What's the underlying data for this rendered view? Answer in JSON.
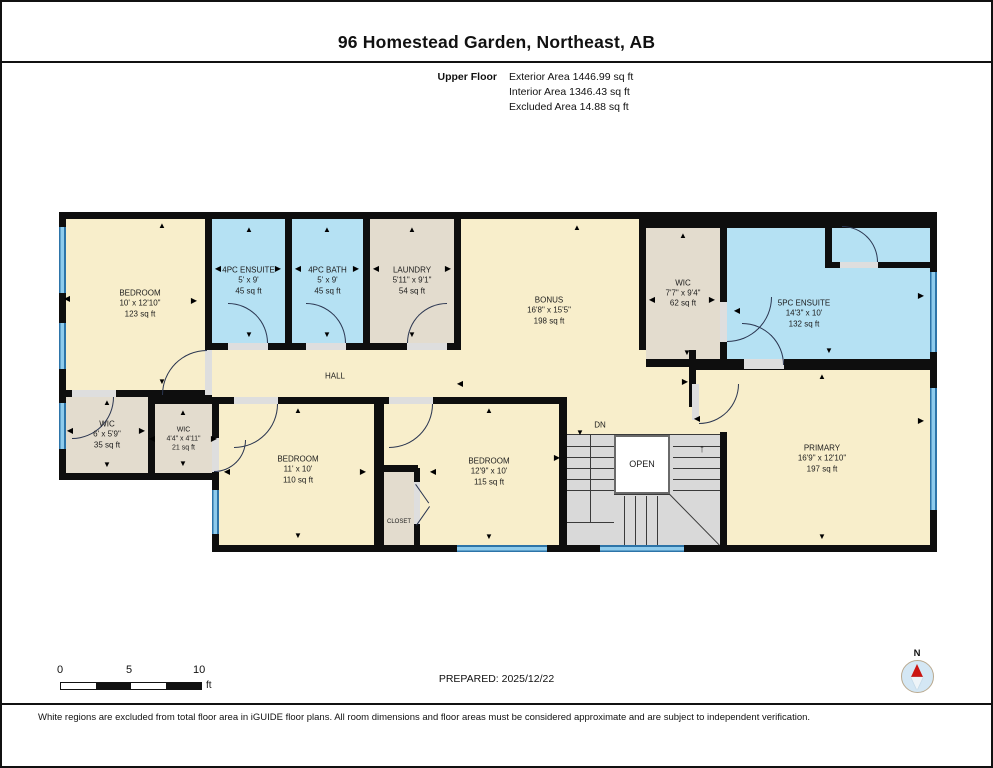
{
  "header": {
    "title": "96 Homestead Garden, Northeast, AB",
    "floor_label": "Upper Floor",
    "stats": [
      "Exterior Area 1446.99 sq ft",
      "Interior Area 1346.43 sq ft",
      "Excluded Area 14.88 sq ft"
    ]
  },
  "colors": {
    "wall": "#0e0e0e",
    "cream": "#f8eecb",
    "blue": "#b5e1f3",
    "tan": "#e3dcce",
    "stair": "#d9d9d9",
    "opening": "#dedede",
    "window_dark": "#2d74a8",
    "window_light": "#8ecbec",
    "door": "#2a3550",
    "line": "#3a3a3a",
    "well": "#ffffff"
  },
  "plan": {
    "base": [
      [
        57,
        210,
        878,
        268
      ],
      [
        210,
        395,
        725,
        155
      ]
    ],
    "rooms": [
      {
        "id": "bedroom-1",
        "name": "BEDROOM",
        "dims": "10' x 12'10\"",
        "area": "123 sq ft",
        "fill": "cream",
        "rect": [
          64,
          217,
          139,
          171
        ],
        "label_at": [
          138,
          302
        ]
      },
      {
        "id": "ensuite-4pc",
        "name": "4PC ENSUITE",
        "dims": "5' x 9'",
        "area": "45 sq ft",
        "fill": "blue",
        "rect": [
          210,
          217,
          73,
          124
        ]
      },
      {
        "id": "bath-4pc",
        "name": "4PC BATH",
        "dims": "5' x 9'",
        "area": "45 sq ft",
        "fill": "blue",
        "rect": [
          290,
          217,
          71,
          124
        ]
      },
      {
        "id": "laundry",
        "name": "LAUNDRY",
        "dims": "5'11\" x 9'1\"",
        "area": "54 sq ft",
        "fill": "tan",
        "rect": [
          368,
          217,
          84,
          124
        ]
      },
      {
        "id": "bonus",
        "name": "BONUS",
        "dims": "16'8\" x 15'5\"",
        "area": "198 sq ft",
        "fill": "cream",
        "rect": [
          459,
          217,
          178,
          178
        ],
        "label_at": [
          547,
          309
        ]
      },
      {
        "id": "wic-upper",
        "name": "WIC",
        "dims": "7'7\" x 9'4\"",
        "area": "62 sq ft",
        "fill": "tan",
        "rect": [
          644,
          226,
          74,
          131
        ]
      },
      {
        "id": "ensuite-5pc",
        "name": "5PC ENSUITE",
        "dims": "14'3\" x 10'",
        "area": "132 sq ft",
        "fill": "blue",
        "rect": [
          725,
          226,
          203,
          131
        ],
        "label_at": [
          802,
          312
        ]
      },
      {
        "id": "hall-left",
        "fill": "cream",
        "rect": [
          210,
          348,
          434,
          47
        ]
      },
      {
        "id": "hall-right",
        "fill": "cream",
        "rect": [
          644,
          365,
          48,
          30
        ]
      },
      {
        "id": "corridor",
        "fill": "cream",
        "rect": [
          565,
          395,
          153,
          38
        ]
      },
      {
        "id": "primary",
        "name": "PRIMARY",
        "dims": "16'9\" x 12'10\"",
        "area": "197 sq ft",
        "fill": "cream",
        "rect": [
          694,
          368,
          234,
          175
        ],
        "label_at": [
          820,
          457
        ]
      },
      {
        "id": "wic-6",
        "name": "WIC",
        "dims": "6' x 5'9\"",
        "area": "35 sq ft",
        "fill": "tan",
        "rect": [
          64,
          395,
          82,
          76
        ]
      },
      {
        "id": "wic-44",
        "name": "WIC",
        "dims": "4'4\" x 4'11\"",
        "area": "21 sq ft",
        "fill": "tan",
        "rect": [
          153,
          402,
          57,
          69
        ],
        "font": 7
      },
      {
        "id": "bedroom-2",
        "name": "BEDROOM",
        "dims": "11' x 10'",
        "area": "110 sq ft",
        "fill": "cream",
        "rect": [
          217,
          402,
          155,
          141
        ],
        "label_at": [
          296,
          468
        ]
      },
      {
        "id": "bedroom-3",
        "name": "BEDROOM",
        "dims": "12'9\" x 10'",
        "area": "115 sq ft",
        "fill": "cream",
        "rect": [
          382,
          402,
          175,
          141
        ],
        "label_at": [
          487,
          470
        ]
      },
      {
        "id": "closet",
        "name": "CLOSET",
        "fill": "tan",
        "rect": [
          382,
          470,
          30,
          73
        ],
        "font": 6,
        "label_at": [
          397,
          521
        ]
      }
    ],
    "stairs": {
      "rect": [
        565,
        433,
        153,
        110
      ],
      "well": [
        612,
        433,
        56,
        59
      ]
    },
    "extra_walls": [
      [
        687,
        348,
        7,
        57
      ],
      [
        412,
        466,
        6,
        77
      ],
      [
        378,
        463,
        38,
        7
      ],
      [
        823,
        226,
        7,
        40
      ],
      [
        823,
        260,
        105,
        6
      ],
      [
        718,
        430,
        7,
        113
      ]
    ],
    "openings": [
      [
        203,
        348,
        7,
        45
      ],
      [
        226,
        341,
        40,
        7
      ],
      [
        304,
        341,
        40,
        7
      ],
      [
        405,
        341,
        40,
        7
      ],
      [
        718,
        300,
        7,
        40
      ],
      [
        742,
        357,
        40,
        10
      ],
      [
        838,
        260,
        38,
        6
      ],
      [
        690,
        382,
        7,
        36
      ],
      [
        70,
        388,
        44,
        7
      ],
      [
        232,
        395,
        44,
        7
      ],
      [
        387,
        395,
        44,
        7
      ],
      [
        210,
        436,
        7,
        34
      ],
      [
        412,
        480,
        6,
        42
      ]
    ],
    "windows": [
      {
        "rect": [
          57,
          225,
          7,
          66
        ],
        "orient": "v"
      },
      {
        "rect": [
          57,
          321,
          7,
          46
        ],
        "orient": "v"
      },
      {
        "rect": [
          57,
          401,
          7,
          46
        ],
        "orient": "v"
      },
      {
        "rect": [
          210,
          488,
          7,
          44
        ],
        "orient": "v"
      },
      {
        "rect": [
          455,
          543,
          90,
          7
        ],
        "orient": "h"
      },
      {
        "rect": [
          598,
          543,
          84,
          7
        ],
        "orient": "h"
      },
      {
        "rect": [
          928,
          270,
          7,
          80
        ],
        "orient": "v"
      },
      {
        "rect": [
          928,
          386,
          7,
          122
        ],
        "orient": "v"
      }
    ],
    "doors": [
      {
        "x": 160,
        "y": 348,
        "r": 45,
        "hinge": "br"
      },
      {
        "x": 226,
        "y": 301,
        "r": 40,
        "hinge": "bl"
      },
      {
        "x": 304,
        "y": 301,
        "r": 40,
        "hinge": "bl"
      },
      {
        "x": 405,
        "y": 301,
        "r": 40,
        "hinge": "br"
      },
      {
        "x": 725,
        "y": 295,
        "r": 45,
        "hinge": "tl"
      },
      {
        "x": 740,
        "y": 321,
        "r": 42,
        "hinge": "bl"
      },
      {
        "x": 840,
        "y": 224,
        "r": 36,
        "hinge": "bl"
      },
      {
        "x": 697,
        "y": 382,
        "r": 40,
        "hinge": "tl"
      },
      {
        "x": 70,
        "y": 395,
        "r": 42,
        "hinge": "tl"
      },
      {
        "x": 232,
        "y": 402,
        "r": 44,
        "hinge": "tl"
      },
      {
        "x": 387,
        "y": 402,
        "r": 44,
        "hinge": "tl"
      },
      {
        "x": 212,
        "y": 438,
        "r": 32,
        "hinge": "tl"
      }
    ],
    "lines": [
      {
        "x": 565,
        "y": 432,
        "len": 153,
        "deg": 0
      },
      {
        "x": 565,
        "y": 444,
        "len": 47,
        "deg": 0
      },
      {
        "x": 565,
        "y": 455,
        "len": 47,
        "deg": 0
      },
      {
        "x": 565,
        "y": 466,
        "len": 47,
        "deg": 0
      },
      {
        "x": 565,
        "y": 477,
        "len": 47,
        "deg": 0
      },
      {
        "x": 565,
        "y": 488,
        "len": 47,
        "deg": 0
      },
      {
        "x": 671,
        "y": 444,
        "len": 47,
        "deg": 0
      },
      {
        "x": 671,
        "y": 455,
        "len": 47,
        "deg": 0
      },
      {
        "x": 671,
        "y": 466,
        "len": 47,
        "deg": 0
      },
      {
        "x": 671,
        "y": 477,
        "len": 47,
        "deg": 0
      },
      {
        "x": 671,
        "y": 488,
        "len": 47,
        "deg": 0
      },
      {
        "x": 623,
        "y": 494,
        "len": 49,
        "deg": 90
      },
      {
        "x": 634,
        "y": 494,
        "len": 49,
        "deg": 90
      },
      {
        "x": 645,
        "y": 494,
        "len": 49,
        "deg": 90
      },
      {
        "x": 656,
        "y": 494,
        "len": 49,
        "deg": 90
      },
      {
        "x": 612,
        "y": 492,
        "len": 56,
        "deg": 0
      },
      {
        "x": 565,
        "y": 520,
        "len": 47,
        "deg": 0
      },
      {
        "x": 589,
        "y": 433,
        "len": 87,
        "deg": 90
      },
      {
        "x": 668,
        "y": 492,
        "len": 71,
        "deg": 45.6
      },
      {
        "x": 414,
        "y": 482,
        "len": 23,
        "deg": 55,
        "c": "door"
      },
      {
        "x": 414,
        "y": 523,
        "len": 23,
        "deg": -55,
        "c": "door"
      }
    ],
    "labels": [
      {
        "id": "hall-label",
        "text": "HALL",
        "x": 333,
        "y": 374,
        "size": 8
      },
      {
        "id": "dn-label",
        "text": "DN",
        "x": 598,
        "y": 423,
        "size": 8
      },
      {
        "id": "open-label",
        "text": "OPEN",
        "x": 640,
        "y": 462,
        "size": 9
      },
      {
        "id": "stairs-up-arrow",
        "text": "↑",
        "x": 700,
        "y": 447,
        "size": 11
      }
    ],
    "arrows": [
      {
        "x": 160,
        "y": 224,
        "d": "up"
      },
      {
        "x": 65,
        "y": 297,
        "d": "left"
      },
      {
        "x": 192,
        "y": 299,
        "d": "right"
      },
      {
        "x": 160,
        "y": 380,
        "d": "down"
      },
      {
        "x": 247,
        "y": 228,
        "d": "up"
      },
      {
        "x": 216,
        "y": 267,
        "d": "left"
      },
      {
        "x": 276,
        "y": 267,
        "d": "right"
      },
      {
        "x": 247,
        "y": 333,
        "d": "down"
      },
      {
        "x": 325,
        "y": 228,
        "d": "up"
      },
      {
        "x": 296,
        "y": 267,
        "d": "left"
      },
      {
        "x": 354,
        "y": 267,
        "d": "right"
      },
      {
        "x": 325,
        "y": 333,
        "d": "down"
      },
      {
        "x": 410,
        "y": 228,
        "d": "up"
      },
      {
        "x": 374,
        "y": 267,
        "d": "left"
      },
      {
        "x": 446,
        "y": 267,
        "d": "right"
      },
      {
        "x": 410,
        "y": 333,
        "d": "down"
      },
      {
        "x": 575,
        "y": 226,
        "d": "up"
      },
      {
        "x": 458,
        "y": 382,
        "d": "left"
      },
      {
        "x": 681,
        "y": 234,
        "d": "up"
      },
      {
        "x": 650,
        "y": 298,
        "d": "left"
      },
      {
        "x": 710,
        "y": 298,
        "d": "right"
      },
      {
        "x": 685,
        "y": 351,
        "d": "down"
      },
      {
        "x": 735,
        "y": 309,
        "d": "left"
      },
      {
        "x": 919,
        "y": 294,
        "d": "right"
      },
      {
        "x": 827,
        "y": 349,
        "d": "down"
      },
      {
        "x": 105,
        "y": 401,
        "d": "up"
      },
      {
        "x": 68,
        "y": 429,
        "d": "left"
      },
      {
        "x": 140,
        "y": 429,
        "d": "right"
      },
      {
        "x": 105,
        "y": 463,
        "d": "down"
      },
      {
        "x": 181,
        "y": 411,
        "d": "up"
      },
      {
        "x": 150,
        "y": 437,
        "d": "left"
      },
      {
        "x": 212,
        "y": 437,
        "d": "right"
      },
      {
        "x": 181,
        "y": 462,
        "d": "down"
      },
      {
        "x": 296,
        "y": 409,
        "d": "up"
      },
      {
        "x": 225,
        "y": 470,
        "d": "left"
      },
      {
        "x": 361,
        "y": 470,
        "d": "right"
      },
      {
        "x": 296,
        "y": 534,
        "d": "down"
      },
      {
        "x": 487,
        "y": 409,
        "d": "up"
      },
      {
        "x": 431,
        "y": 470,
        "d": "left"
      },
      {
        "x": 555,
        "y": 456,
        "d": "right"
      },
      {
        "x": 487,
        "y": 535,
        "d": "down"
      },
      {
        "x": 820,
        "y": 375,
        "d": "up"
      },
      {
        "x": 695,
        "y": 417,
        "d": "left"
      },
      {
        "x": 683,
        "y": 380,
        "d": "right"
      },
      {
        "x": 919,
        "y": 419,
        "d": "right"
      },
      {
        "x": 820,
        "y": 535,
        "d": "down"
      },
      {
        "x": 578,
        "y": 431,
        "d": "down"
      }
    ]
  },
  "footer": {
    "scale": {
      "ticks": [
        "0",
        "5",
        "10"
      ],
      "unit": "ft"
    },
    "prepared": "PREPARED: 2025/12/22",
    "compass": "N",
    "disclaimer": "White regions are excluded from total floor area in iGUIDE floor plans. All room dimensions and floor areas must be considered approximate and are subject to independent verification."
  }
}
